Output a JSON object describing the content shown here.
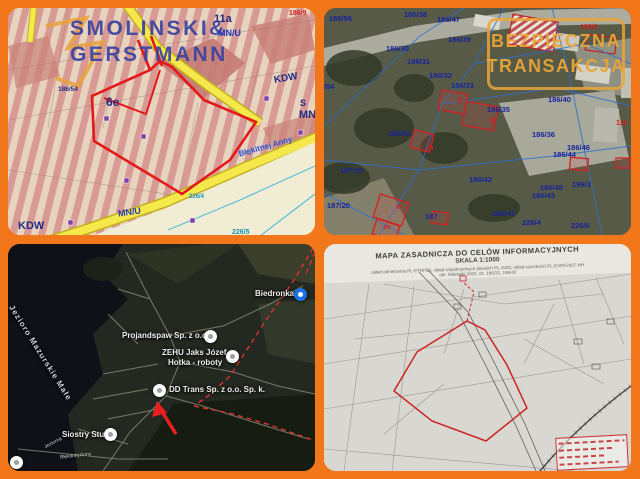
{
  "frame": {
    "background": "#F2771A"
  },
  "plan": {
    "watermark_line1": "SMOLINSKI&",
    "watermark_line2": "GERSTMANN",
    "zone_11a": "11a",
    "zone_mnu_top": "MN/U",
    "parcel_186_9": "186/9",
    "kdw_right": "KDW",
    "zone_s": "S",
    "zone_mn": "MN",
    "parcel_6e": "6e",
    "parcel_186_54": "186/54",
    "zone_mnu_bottom": "MN/U",
    "kdw_bottom": "KDW",
    "parcel_226_4": "226/4",
    "parcel_226_5": "226/5",
    "road_name": "Błękitnej Anny"
  },
  "aerial": {
    "watermark_line1": "BEZPIECZNA",
    "watermark_line2": "TRANSAKCJA",
    "parcels": [
      "186/56",
      "186/38",
      "186/47",
      "186/39",
      "186/30",
      "186/31",
      "186/32",
      "186/33",
      "186/35",
      "186/40",
      "186/34",
      "186/36",
      "186/46",
      "186/44",
      "187/19",
      "186/42",
      "186/45",
      "186/43",
      "199/3",
      "187/20",
      "186/41",
      "226/4",
      "226/6",
      "/54",
      "187"
    ],
    "red_labels": [
      "186/6",
      "112",
      "m",
      "m",
      "m",
      "g",
      "g"
    ]
  },
  "satellite": {
    "lake_label": "Jezioro Mazurskie Małe",
    "poi_biedronka": "Biedronka",
    "poi_projandspaw": "Projandspaw Sp. z o.o.",
    "poi_zehu_line1": "ZEHU Jaks Józef",
    "poi_zehu_line2": "Hotka - roboty",
    "poi_ddtrans": "DD Trans Sp. z o.o. Sp. k.",
    "poi_siostry": "Siostry Studio",
    "road_jeziorna": "Jeziorna",
    "road_blekitnej": "Błękitnej Anny"
  },
  "scan": {
    "title": "MAPA ZASADNICZA DO CELÓW INFORMACYJNYCH",
    "scale": "SKALA 1:1000",
    "meta_line1": "układ odniesienia PL-ETRF89, układ współrzędnych płaskich PL-2000, układ wysokości PL-EVRF2007-NH",
    "meta_line2": "obr. Mikołajki 0002, dz. 186/32, 186/42"
  }
}
